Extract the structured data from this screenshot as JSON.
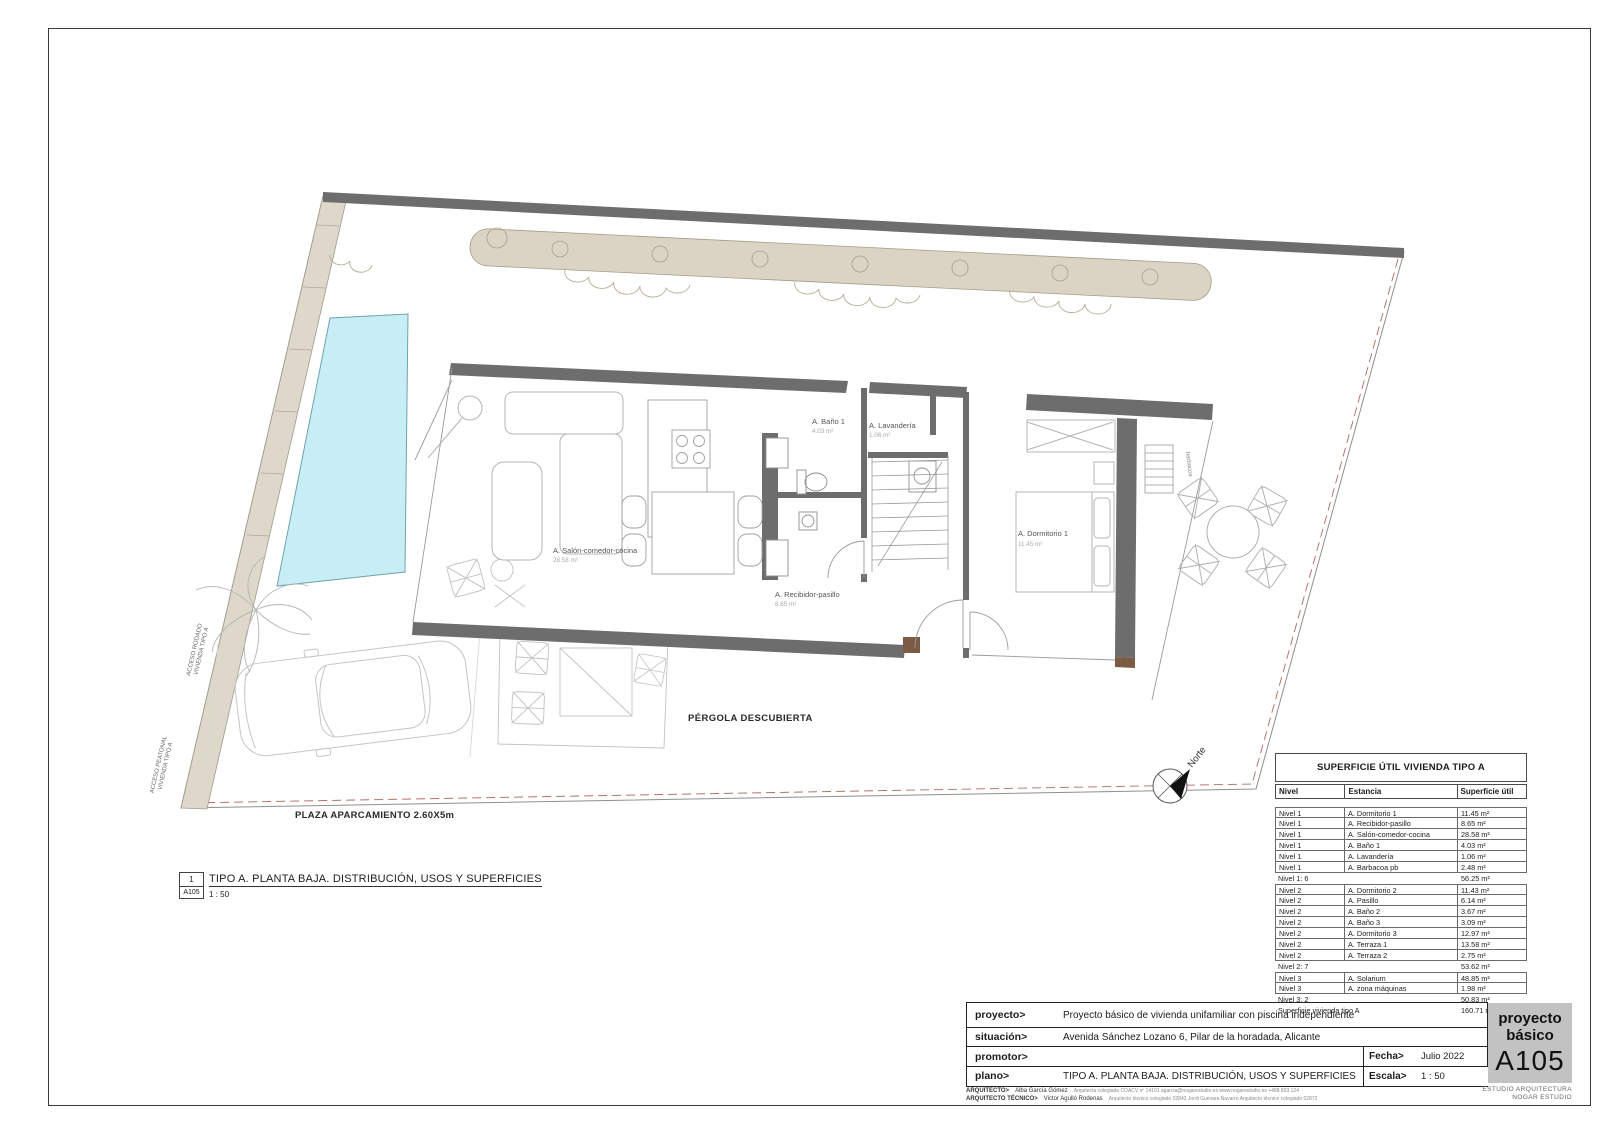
{
  "plan": {
    "rooms": [
      {
        "name": "A. Salón-comedor-cocina",
        "area": "28.58 m²"
      },
      {
        "name": "A. Baño 1",
        "area": "4.03 m²"
      },
      {
        "name": "A. Lavandería",
        "area": "1.06 m²"
      },
      {
        "name": "A. Recibidor-pasillo",
        "area": "8.65 m²"
      },
      {
        "name": "A. Dormitorio 1",
        "area": "11.45 m²"
      }
    ],
    "labels": {
      "pergola": "PÉRGOLA DESCUBIERTA",
      "parking": "PLAZA APARCAMIENTO 2.60X5m",
      "acceso_rodado_1": "ACCESO RODADO",
      "acceso_rodado_2": "VIVIENDA TIPO A",
      "acceso_peatonal_1": "ACCESO PEATONAL",
      "acceso_peatonal_2": "VIVIENDA TIPO A",
      "barbacoa": "barbacoa",
      "norte": "Norte"
    }
  },
  "drawing_title": {
    "number": "1",
    "sheet": "A105",
    "title": "TIPO A. PLANTA BAJA. DISTRIBUCIÓN, USOS Y SUPERFICIES",
    "scale": "1 : 50"
  },
  "area_table": {
    "title": "SUPERFICIE ÚTIL VIVIENDA TIPO A",
    "columns": [
      "Nivel",
      "Estancia",
      "Superficie útil"
    ],
    "rows": [
      {
        "t": "d",
        "c1": "Nivel 1",
        "c2": "A. Dormitorio 1",
        "c3": "11.45 m²"
      },
      {
        "t": "d",
        "c1": "Nivel 1",
        "c2": "A. Recibidor-pasillo",
        "c3": "8.65 m²"
      },
      {
        "t": "d",
        "c1": "Nivel 1",
        "c2": "A. Salón-comedor-cocina",
        "c3": "28.58 m²"
      },
      {
        "t": "d",
        "c1": "Nivel 1",
        "c2": "A. Baño 1",
        "c3": "4.03 m²"
      },
      {
        "t": "d",
        "c1": "Nivel 1",
        "c2": "A. Lavandería",
        "c3": "1.06 m²"
      },
      {
        "t": "d",
        "c1": "Nivel 1",
        "c2": "A. Barbacoa pb",
        "c3": "2.48 m²"
      },
      {
        "t": "s",
        "c1": "Nivel 1: 6",
        "c2": "",
        "c3": "56.25 m²"
      },
      {
        "t": "d",
        "c1": "Nivel 2",
        "c2": "A. Dormitorio 2",
        "c3": "11.43 m²"
      },
      {
        "t": "d",
        "c1": "Nivel 2",
        "c2": "A. Pasillo",
        "c3": "6.14 m²"
      },
      {
        "t": "d",
        "c1": "Nivel 2",
        "c2": "A. Baño 2",
        "c3": "3.67 m²"
      },
      {
        "t": "d",
        "c1": "Nivel 2",
        "c2": "A. Baño 3",
        "c3": "3.09 m²"
      },
      {
        "t": "d",
        "c1": "Nivel 2",
        "c2": "A. Dormitorio 3",
        "c3": "12.97 m²"
      },
      {
        "t": "d",
        "c1": "Nivel 2",
        "c2": "A. Terraza 1",
        "c3": "13.58 m²"
      },
      {
        "t": "d",
        "c1": "Nivel 2",
        "c2": "A. Terraza 2",
        "c3": "2.75 m²"
      },
      {
        "t": "s",
        "c1": "Nivel 2: 7",
        "c2": "",
        "c3": "53.62 m²"
      },
      {
        "t": "d",
        "c1": "Nivel 3",
        "c2": "A. Solarium",
        "c3": "48.85 m²"
      },
      {
        "t": "d",
        "c1": "Nivel 3",
        "c2": "A. zona máquinas",
        "c3": "1.98 m²"
      },
      {
        "t": "s",
        "c1": "Nivel 3: 2",
        "c2": "",
        "c3": "50.83 m²"
      },
      {
        "t": "t",
        "c1": "Superficie vivienda tipo A",
        "c2": "",
        "c3": "160.71 m²"
      }
    ]
  },
  "title_block": {
    "rows": [
      {
        "label": "proyecto>",
        "value": "Proyecto básico de vivienda unifamiliar con piscina independiente"
      },
      {
        "label": "situación>",
        "value": "Avenida Sánchez Lozano 6, Pilar de la horadada, Alicante"
      },
      {
        "label": "promotor>",
        "value": ""
      },
      {
        "label": "plano>",
        "value": "TIPO A. PLANTA BAJA. DISTRIBUCIÓN, USOS Y SUPERFICIES"
      }
    ],
    "fecha_label": "Fecha>",
    "fecha": "Julio 2022",
    "escala_label": "Escala>",
    "escala": "1 : 50",
    "architects": [
      {
        "label": "ARQUITECTO>",
        "name": "Alba García Gómez",
        "info": "Arquitecta colegiada COACV nº 14101    agarcia@nogarestudio.es    www.nogarestudio.es    +488 893 124"
      },
      {
        "label": "ARQUITECTO TÉCNICO>",
        "name": "Victor Agulló Rodenas",
        "info": "Arquitecto técnico colegiado 02843    Jordi Guevara Navarro    Arquitecto técnico colegiado 02872"
      }
    ]
  },
  "stamp": {
    "line1": "proyecto",
    "line2": "básico",
    "code": "A105",
    "studio_line1": "ESTUDIO ARQUITECTURA",
    "studio_line2": "NOGAR ESTUDIO"
  },
  "colors": {
    "wall": "#6d6d6d",
    "wood": "#7b5b43",
    "pool": "#c7edf5",
    "hedge": "#dbd4c4",
    "stamp_bg": "#c2c2c2"
  }
}
